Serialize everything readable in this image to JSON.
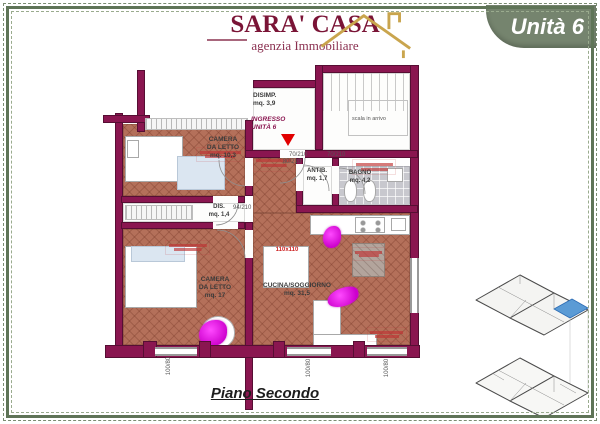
{
  "logo": {
    "title": "SARA' CASA",
    "subtitle": "agenzia Immobiliare"
  },
  "badge": {
    "label": "Unità 6"
  },
  "plan_title": "Piano Secondo",
  "rooms": {
    "camera1": "CAMERA\nDA LETTO\nmq. 10,3",
    "disimp": "DISIMP.\nmq. 3,9",
    "ingresso": "INGRESSO\nUNITÀ 6",
    "antib": "ANTIB.\nmq. 1,7",
    "bagno": "BAGNO\nmq. 4,2",
    "dis": "DIS.\nmq. 1,4",
    "camera2": "CAMERA\nDA LETTO\nmq. 17",
    "cucina": "CUCINA/SOGGIORNO\nmq. 31,5"
  },
  "stairs": {
    "label": "scala in arrivo"
  },
  "dims": {
    "entrance_door": "80/210",
    "antib_door": "70/210",
    "bagno_door": "70/210",
    "dis_door": "94/210",
    "window_left": "100/80",
    "window_center": "100/80",
    "window_right": "100/80"
  },
  "furniture": {
    "table_label": "110x110"
  },
  "colors": {
    "wall": "#8a1650",
    "floor_terracotta": "#b4705a",
    "badge_green": "#75846e",
    "frame_green": "#5f7457",
    "highlight_blue": "#5b9bd5",
    "accent_red": "#e10000",
    "logo_maroon": "#7a1436",
    "logo_gold": "#c9a54e",
    "magenta_decor": "#e015e0"
  }
}
